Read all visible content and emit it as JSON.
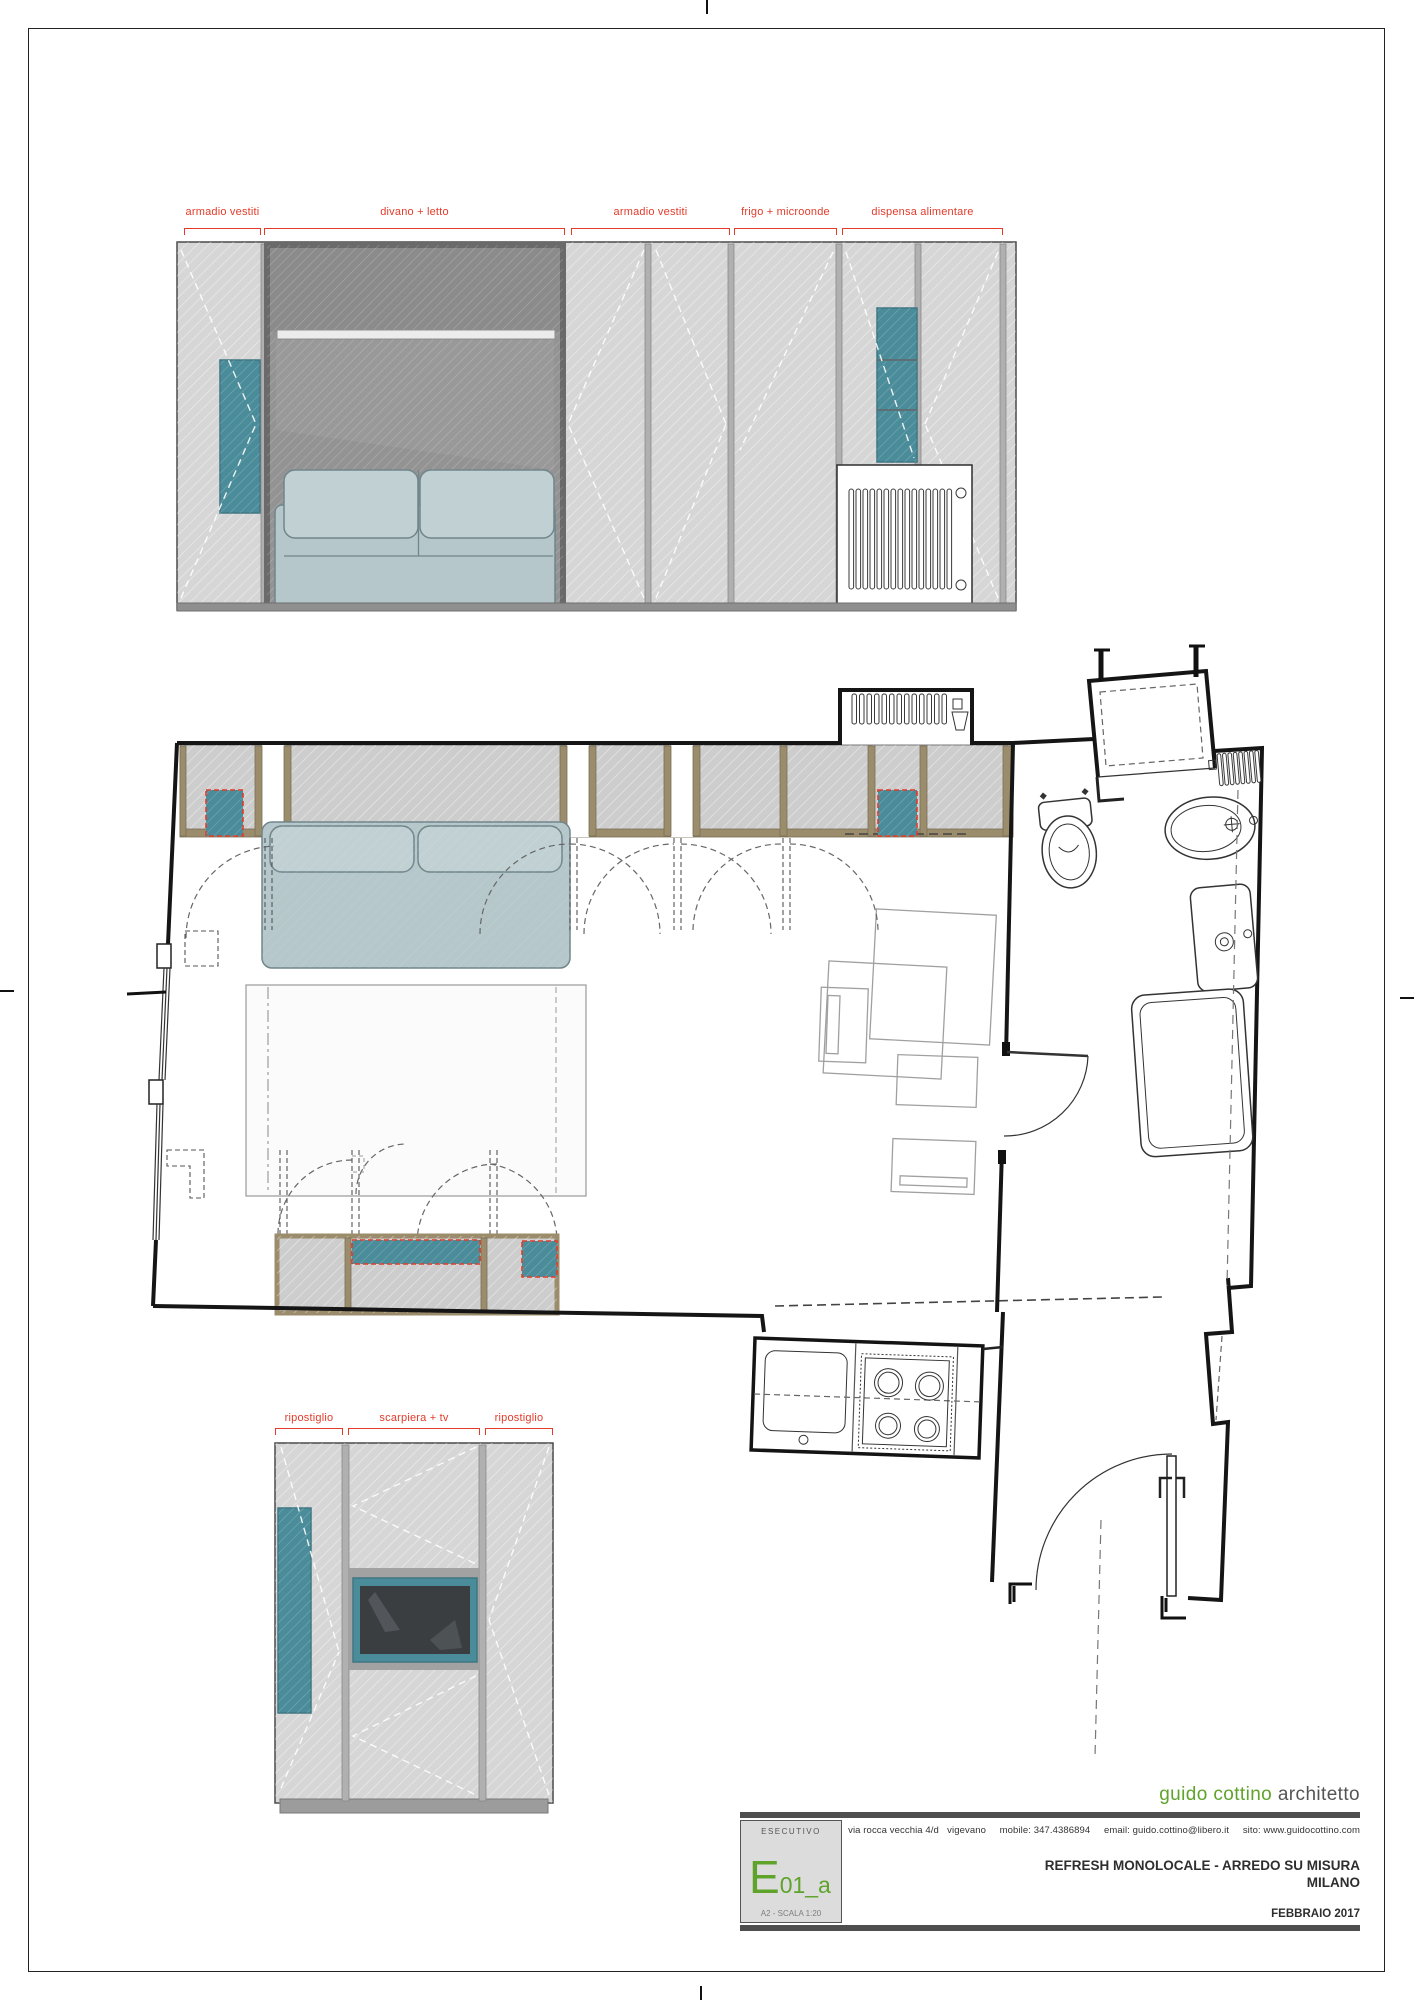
{
  "elevation_top": {
    "labels": [
      {
        "text": "armadio vestiti"
      },
      {
        "text": "divano + letto"
      },
      {
        "text": "armadio vestiti"
      },
      {
        "text": "frigo + microonde"
      },
      {
        "text": "dispensa alimentare"
      }
    ]
  },
  "elevation_bottom": {
    "labels": [
      {
        "text": "ripostiglio"
      },
      {
        "text": "scarpiera + tv"
      },
      {
        "text": "ripostiglio"
      }
    ]
  },
  "title_block": {
    "studio_name_green": "guido cottino",
    "studio_name_gray": "architetto",
    "contact_line": "via rocca vecchia 4/d   vigevano     mobile: 347.4386894     email: guido.cottino@libero.it     sito: www.guidocottino.com",
    "phase": "ESECUTIVO",
    "code_letter": "E",
    "code_suffix": "01_a",
    "format_scale": "A2 - SCALA 1:20",
    "project_title_line1": "REFRESH MONOLOCALE - ARREDO SU MISURA",
    "project_title_line2": "MILANO",
    "date": "FEBBRAIO 2017"
  },
  "colors": {
    "red": "#e23b2a",
    "teal": "#4a8c99",
    "green": "#5fa32b",
    "tan": "#9b8c6b",
    "panel": "#d6d6d6",
    "niche": "#8f8f8f"
  }
}
